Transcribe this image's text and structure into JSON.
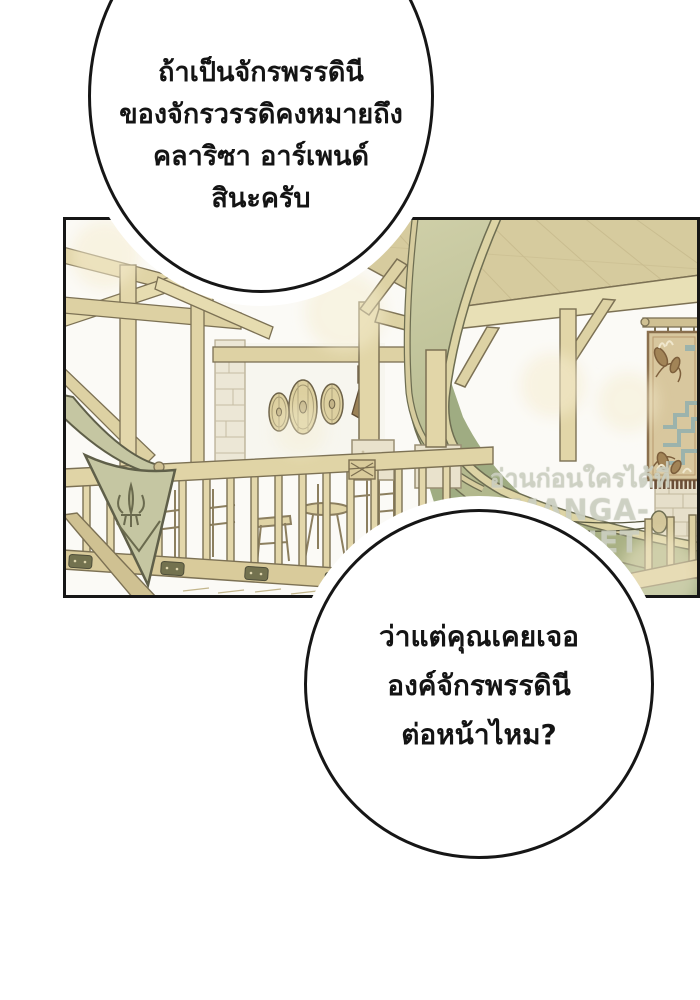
{
  "bubbles": [
    {
      "lines": [
        "ถ้าเป็นจักรพรรดินี",
        "ของจักรวรรดิคงหมายถึง",
        "คลาริซา อาร์เพนด์",
        "สินะครับ"
      ]
    },
    {
      "lines": [
        "ว่าแต่คุณเคยเจอ",
        "องค์จักรพรรดินี",
        "ต่อหน้าไหม?"
      ]
    }
  ],
  "watermark": {
    "line1": "อ่านก่อนใครได้ที่",
    "line2": "MANGA-LC.NET"
  },
  "scene": {
    "colors": {
      "wood_light": "#e6dcb0",
      "wood_mid": "#ddd1a3",
      "wood_edge": "#cdbf90",
      "outline": "#7c7154",
      "ceiling": "#d6cb9e",
      "white_wall": "#f7f6ef",
      "swoosh_top": "#cfcfa8",
      "swoosh_bottom": "#a9b184",
      "deep_green": "#9aa87b",
      "banner_green": "#c5c6a2",
      "banner_outline": "#5f5f49",
      "stone": "#ece7d6",
      "marble": "#e9e2cc",
      "tapestry_bg": "#d8c79e",
      "tapestry_border": "#8a6f4d",
      "tapestry_teal": "#9cb3ac",
      "tapestry_brown": "#a28457",
      "fringe_brown": "#6b4f38",
      "metal_plate": "#7372556",
      "panel_border": "#161616"
    },
    "elements": [
      "ceiling-beams",
      "timber-lattice",
      "stone-pillar",
      "round-shields",
      "torch-sconce",
      "curved-green-beam",
      "wall-tapestry",
      "brick-wall",
      "wooden-railing",
      "fleur-de-lis-banner",
      "tavern-chairs"
    ]
  }
}
